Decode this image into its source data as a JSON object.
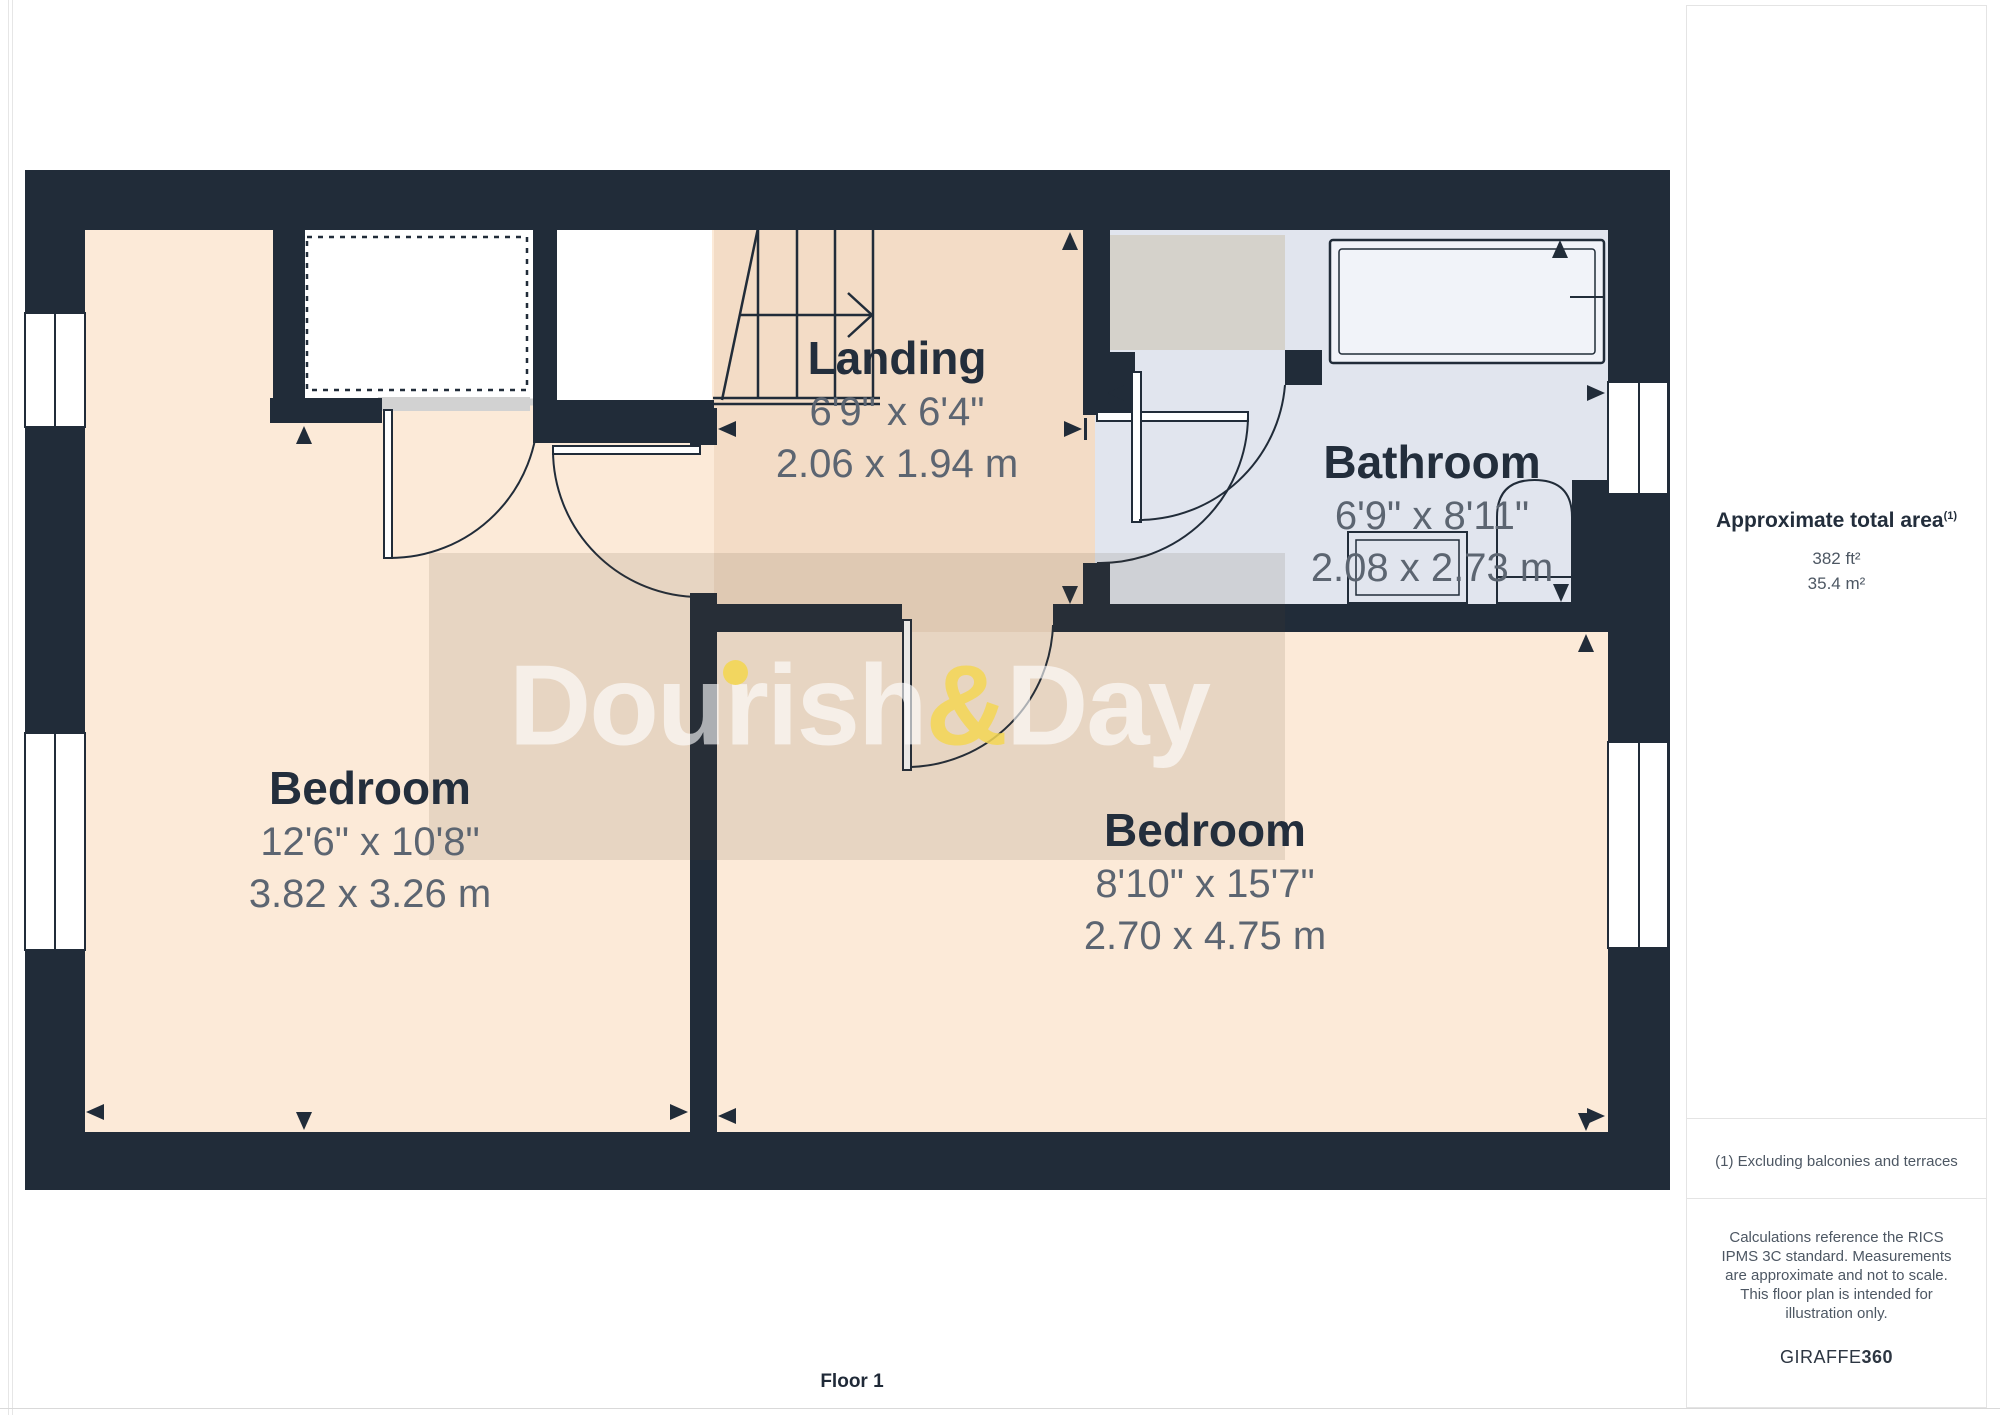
{
  "page": {
    "floor_label": "Floor 1"
  },
  "watermark": {
    "first": "Dour",
    "i": "i",
    "rest": "sh",
    "amp": "&",
    "second": "Day"
  },
  "rooms": {
    "bedroom_left": {
      "name": "Bedroom",
      "imperial": "12'6\" x 10'8\"",
      "metric": "3.82 x 3.26 m"
    },
    "landing": {
      "name": "Landing",
      "imperial": "6'9\" x 6'4\"",
      "metric": "2.06 x 1.94 m"
    },
    "bathroom": {
      "name": "Bathroom",
      "imperial": "6'9\" x 8'11\"",
      "metric": "2.08 x 2.73 m"
    },
    "bedroom_right": {
      "name": "Bedroom",
      "imperial": "8'10\" x 15'7\"",
      "metric": "2.70 x 4.75 m"
    }
  },
  "sidebar": {
    "total_area_label": "Approximate total area",
    "total_area_superscript": "(1)",
    "area_ft": "382 ft²",
    "area_m": "35.4 m²",
    "footnote_1": "(1) Excluding balconies and terraces",
    "disclaimer": "Calculations reference the RICS IPMS 3C standard. Measurements are approximate and not to scale. This floor plan is intended for illustration only.",
    "brand_name": "GIRAFFE",
    "brand_number": "360"
  },
  "colors": {
    "wall": "#212c39",
    "bedroom_floor": "#fcead8",
    "landing_floor": "#f3dcc6",
    "bathroom_floor": "#e1e5ee",
    "stair_void_gray": "#d5d2cb",
    "closet_rim_gray": "#d2d2d2",
    "dimension_text": "#5c6571",
    "label_text": "#232e3c",
    "watermark_yellow": "#f3d654"
  }
}
